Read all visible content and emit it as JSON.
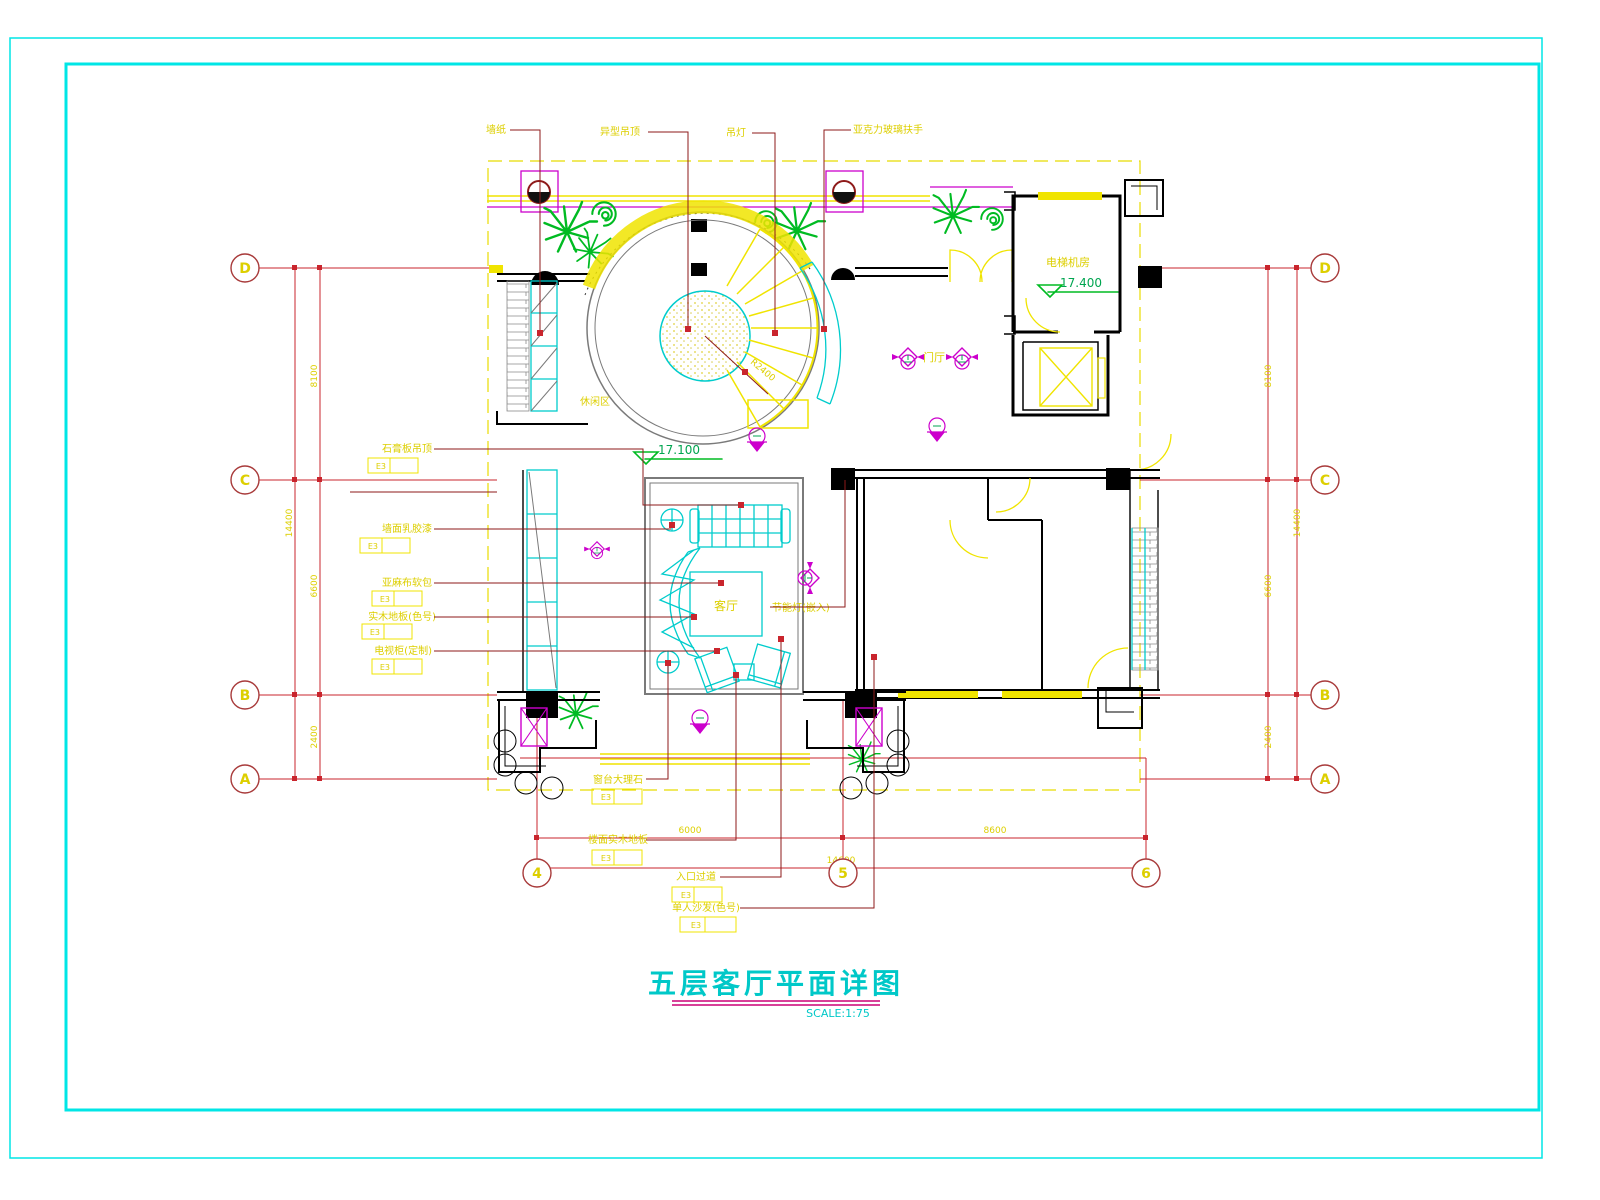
{
  "drawing": {
    "title": "五层客厅平面详图",
    "scale": "SCALE:1:75"
  },
  "grid": {
    "rows": [
      "D",
      "C",
      "B",
      "A"
    ],
    "cols": [
      "4",
      "5",
      "6"
    ]
  },
  "dimensions": {
    "left": {
      "segments": [
        "8100",
        "6600",
        "2400"
      ],
      "overall": "14400"
    },
    "right": {
      "segments": [
        "8100",
        "6600",
        "2400"
      ],
      "overall": "14400"
    },
    "bottom": {
      "segments": [
        "6000",
        "8600"
      ],
      "overall": "14600"
    }
  },
  "levels": {
    "atrium": "17.100",
    "machine_room": "17.400"
  },
  "rooms": {
    "living_room": "客厅",
    "foyer": "门厅",
    "machine_room": "电梯机房",
    "leisure": "休闲区"
  },
  "annotations": {
    "top": [
      "墙纸",
      "异型吊顶",
      "吊灯",
      "亚克力玻璃扶手"
    ],
    "left": [
      "石膏板吊顶",
      "墙面乳胶漆",
      "亚麻布软包",
      "实木地板(色号)",
      "电视柜(定制)"
    ],
    "bottom": [
      "窗台大理石",
      "楼面实木地板",
      "入口过道",
      "单人沙发(色号)"
    ],
    "right_note": "节能灯(嵌入)",
    "radius": "R2400",
    "tag": "E3"
  },
  "colors": {
    "frame": "#00e6e6",
    "grid_line": "#c9252d",
    "bubble_ring": "#a83a3a",
    "annotation_yellow": "#ddcf00",
    "line_yellow": "#f0e400",
    "wall_black": "#000000",
    "furniture_cyan": "#00cccc",
    "plant_green": "#00bb22",
    "level_green": "#00a550",
    "symbol_magenta": "#cc00cc",
    "room_outline_gray": "#7a7a7a",
    "title_cyan": "#00c8c8",
    "underline_magenta": "#cc0077"
  }
}
